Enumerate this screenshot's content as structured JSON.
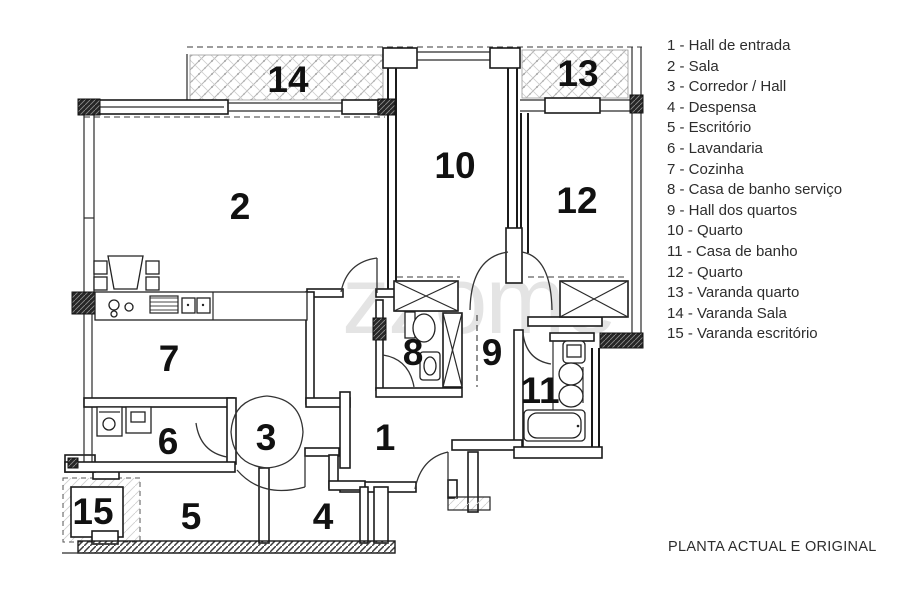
{
  "footer": {
    "title": "PLANTA ACTUAL E ORIGINAL"
  },
  "watermark": {
    "text": "zzome",
    "color": "#e4e4e4"
  },
  "colors": {
    "ink": "#1b1b1b",
    "hatch_light": "#b5b5b5",
    "paper": "#ffffff"
  },
  "legend": {
    "items": [
      "1 - Hall de entrada",
      "2 - Sala",
      "3 - Corredor / Hall",
      "4 - Despensa",
      "5 - Escritório",
      "6 - Lavandaria",
      "7 - Cozinha",
      "8 - Casa de banho serviço",
      "9 - Hall dos quartos",
      "10 - Quarto",
      "11 - Casa de banho",
      "12 - Quarto",
      "13 - Varanda quarto",
      "14 - Varanda Sala",
      "15 - Varanda escritório"
    ]
  },
  "plan": {
    "labels": {
      "r1": "1",
      "r2": "2",
      "r3": "3",
      "r4": "4",
      "r5": "5",
      "r6": "6",
      "r7": "7",
      "r8": "8",
      "r9": "9",
      "r10": "10",
      "r11": "11",
      "r12": "12",
      "r13": "13",
      "r14": "14",
      "r15": "15"
    }
  }
}
